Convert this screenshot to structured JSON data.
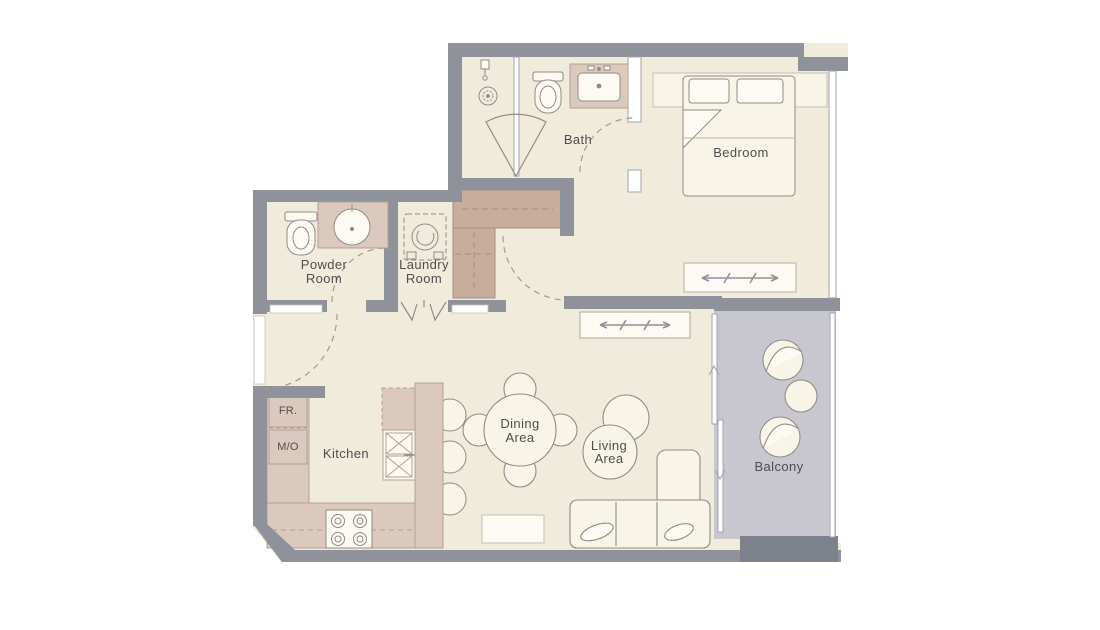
{
  "plan": {
    "rooms": {
      "bath": {
        "label": "Bath"
      },
      "bedroom": {
        "label": "Bedroom"
      },
      "powder": {
        "line1": "Powder",
        "line2": "Room"
      },
      "laundry": {
        "line1": "Laundry",
        "line2": "Room"
      },
      "kitchen": {
        "label": "Kitchen"
      },
      "dining": {
        "line1": "Dining",
        "line2": "Area"
      },
      "living": {
        "line1": "Living",
        "line2": "Area"
      },
      "balcony": {
        "label": "Balcony"
      }
    },
    "appliances": {
      "fridge": "FR.",
      "micro_oven": "M/O"
    },
    "colors": {
      "wall": "#8f929b",
      "wall_dark": "#7d818b",
      "floor": "#f1ebdc",
      "cabinet": "#dcc9be",
      "closet": "#c8ad9c",
      "balcony_floor": "#c8c6ce",
      "furniture_fill": "#f8f4e7",
      "text": "#4e4e4e"
    }
  }
}
